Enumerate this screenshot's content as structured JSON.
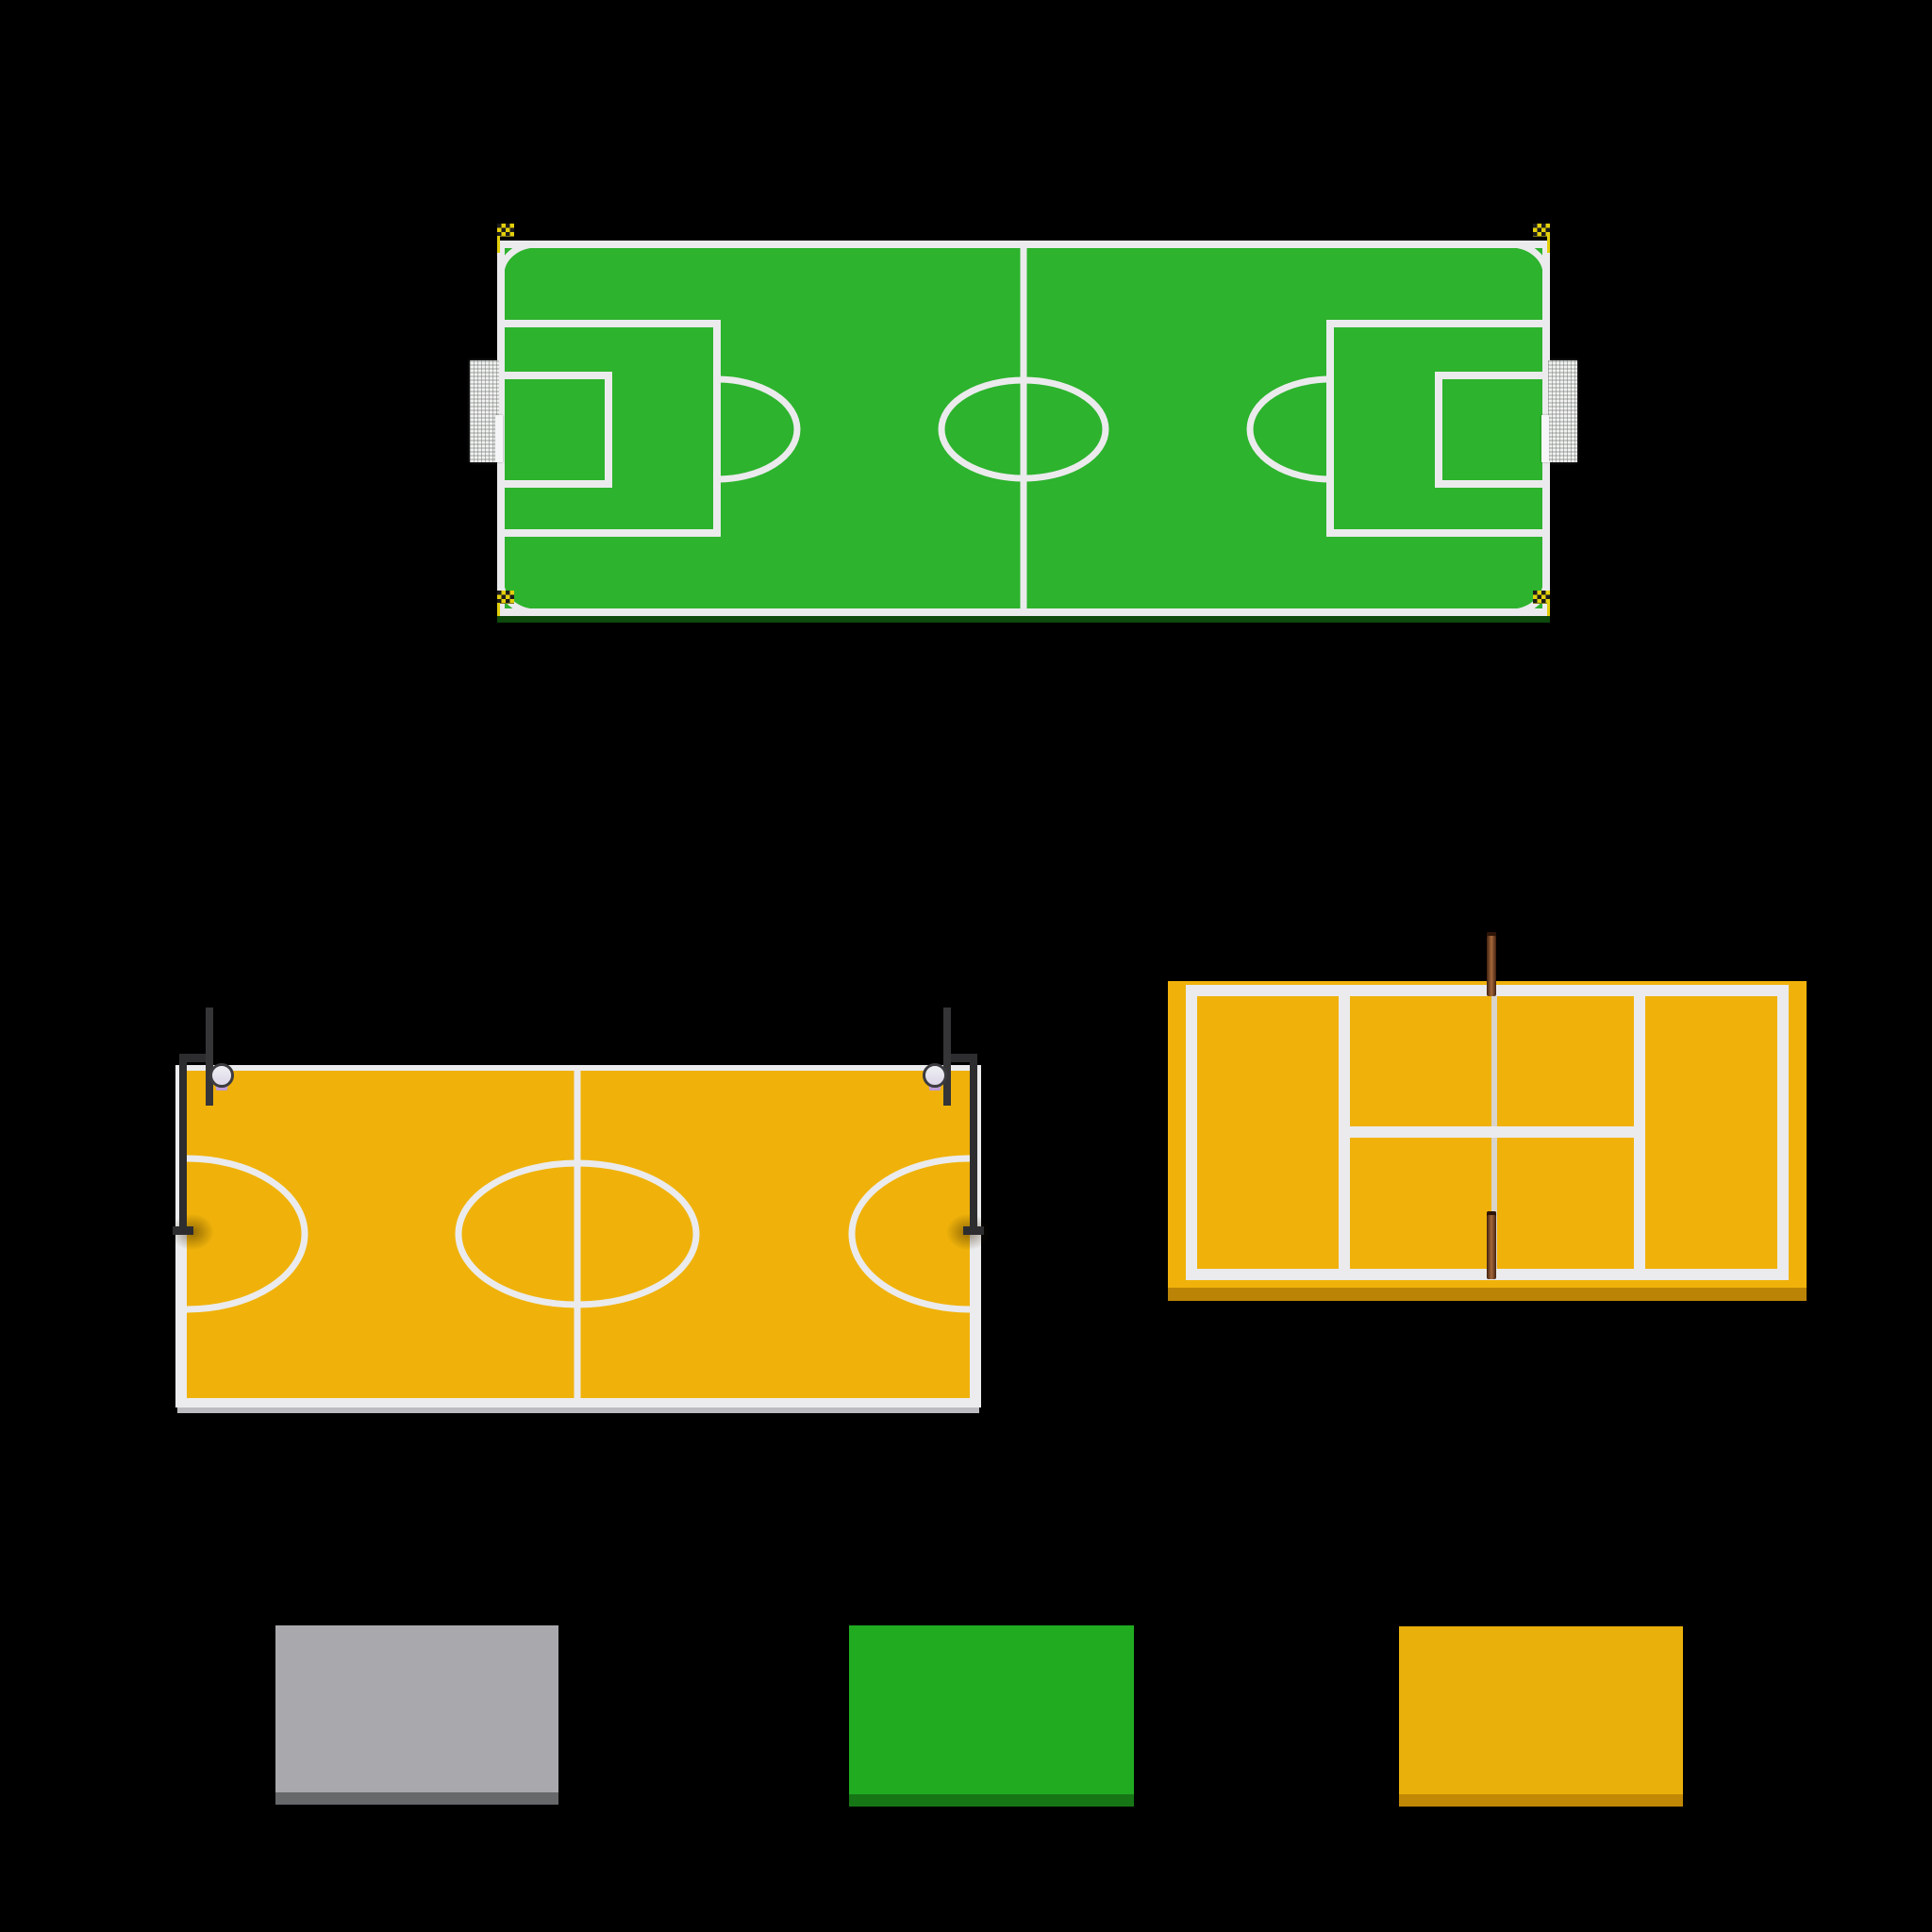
{
  "scene": {
    "description": "Top-down 3D renders of sports ground assets on a black background",
    "objects": [
      {
        "name": "soccer-field",
        "label": "Soccer field"
      },
      {
        "name": "basketball-court",
        "label": "Basketball court"
      },
      {
        "name": "tennis-court",
        "label": "Tennis court"
      },
      {
        "name": "ground-slab-gray",
        "label": "Gray ground slab"
      },
      {
        "name": "ground-slab-green",
        "label": "Green ground slab"
      },
      {
        "name": "ground-slab-yellow",
        "label": "Yellow ground slab"
      }
    ]
  },
  "colors": {
    "background": "#000000",
    "line_white": "#ebebed",
    "slab_white": "#ececee",
    "soccer_green": "#2db32d",
    "soccer_green_side": "#0e4a0e",
    "court_yellow": "#f0b20a",
    "court_yellow_side": "#bb8406",
    "swatch_gray": "#a9a9ad",
    "swatch_gray_side": "#67686a",
    "swatch_green": "#21ab21",
    "swatch_green_side": "#167616",
    "swatch_yellow": "#e9b00b",
    "swatch_yellow_side": "#c18806",
    "pole_dark": "#2d2d2f",
    "backboard_dark": "#353538",
    "rim_light": "#eef0f4",
    "net_pink": "#f0bcd8",
    "net_purple": "#b697e2",
    "tennis_post_brown": "#6e3a1e",
    "tennis_post_highlight": "#a5683a",
    "tennis_net_line": "#d6d6dc",
    "flag_yellow": "#e3cf0b",
    "flag_black": "#1c1c1c",
    "goal_net_light": "#f1f2f1",
    "goal_net_dark": "#c7cac7"
  }
}
